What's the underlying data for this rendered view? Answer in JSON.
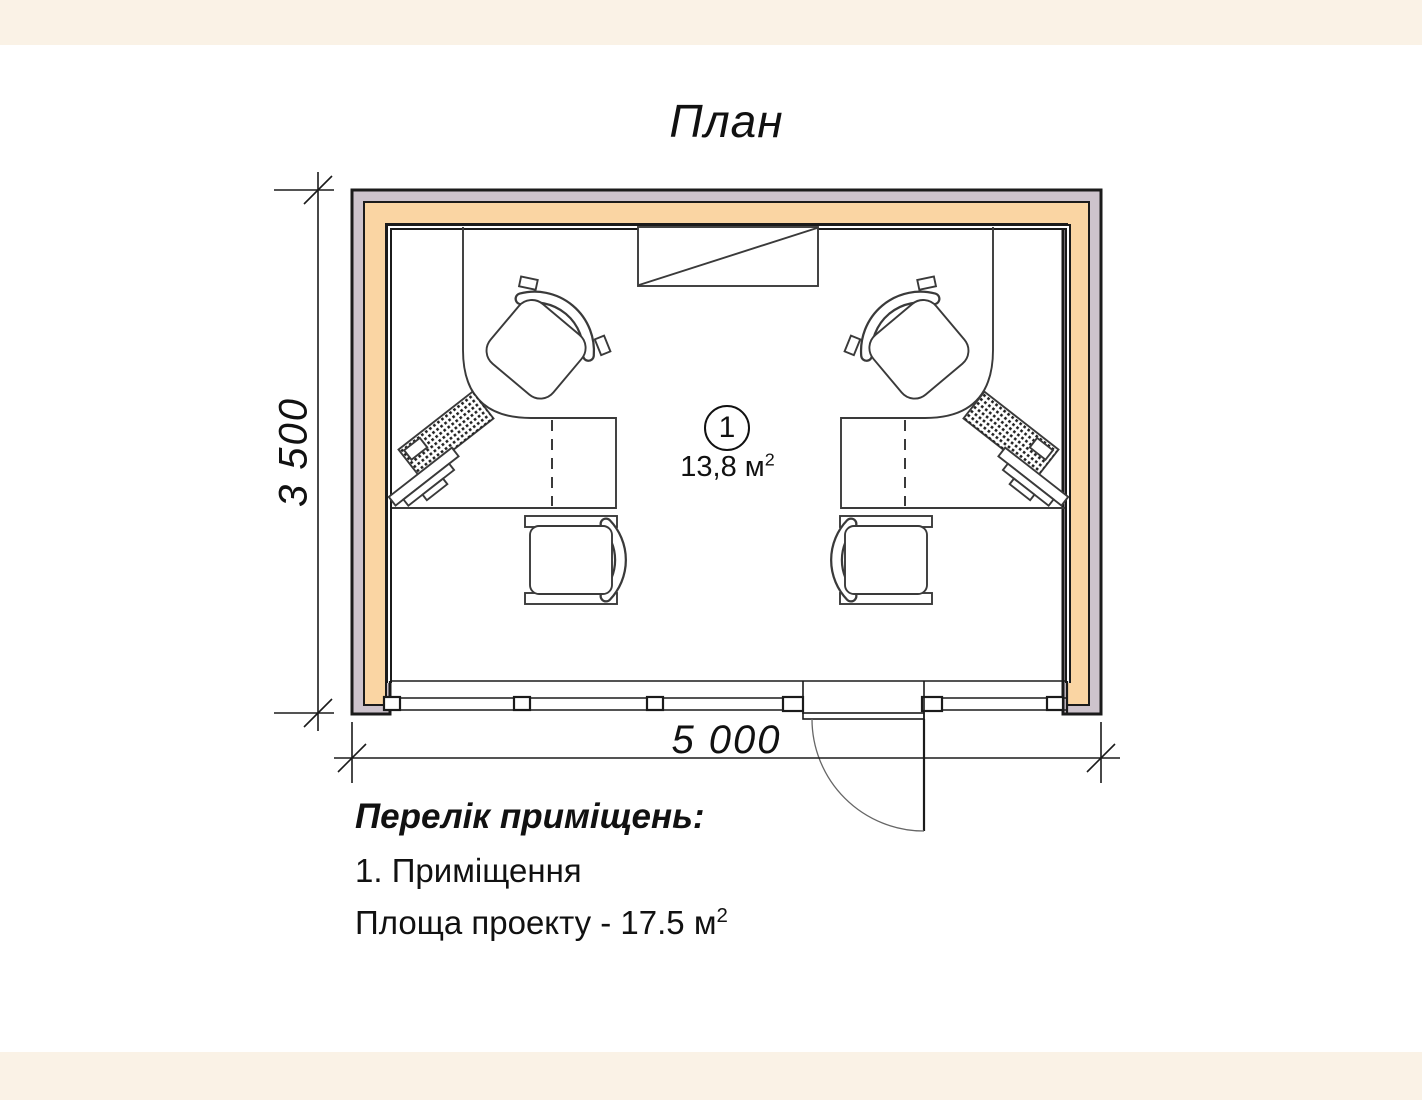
{
  "title": "План",
  "dimensions": {
    "width_label": "5 000",
    "height_label": "3 500"
  },
  "room": {
    "number": "1",
    "area_value": "13,8 м",
    "area_sup": "2"
  },
  "legend": {
    "heading": "Перелік приміщень:",
    "items": [
      "1. Приміщення"
    ],
    "project_area": "Площа проекту - 17.5 м",
    "project_area_sup": "2"
  },
  "colors": {
    "page_bg": "#FAF2E6",
    "stage_bg": "#FFFFFF",
    "wall_outer": "#CDC3CC",
    "wall_core": "#FAD5A3",
    "line": "#1B1B1B",
    "thin_line": "#3A3A3A",
    "arc_line": "#666666",
    "text": "#111111"
  }
}
